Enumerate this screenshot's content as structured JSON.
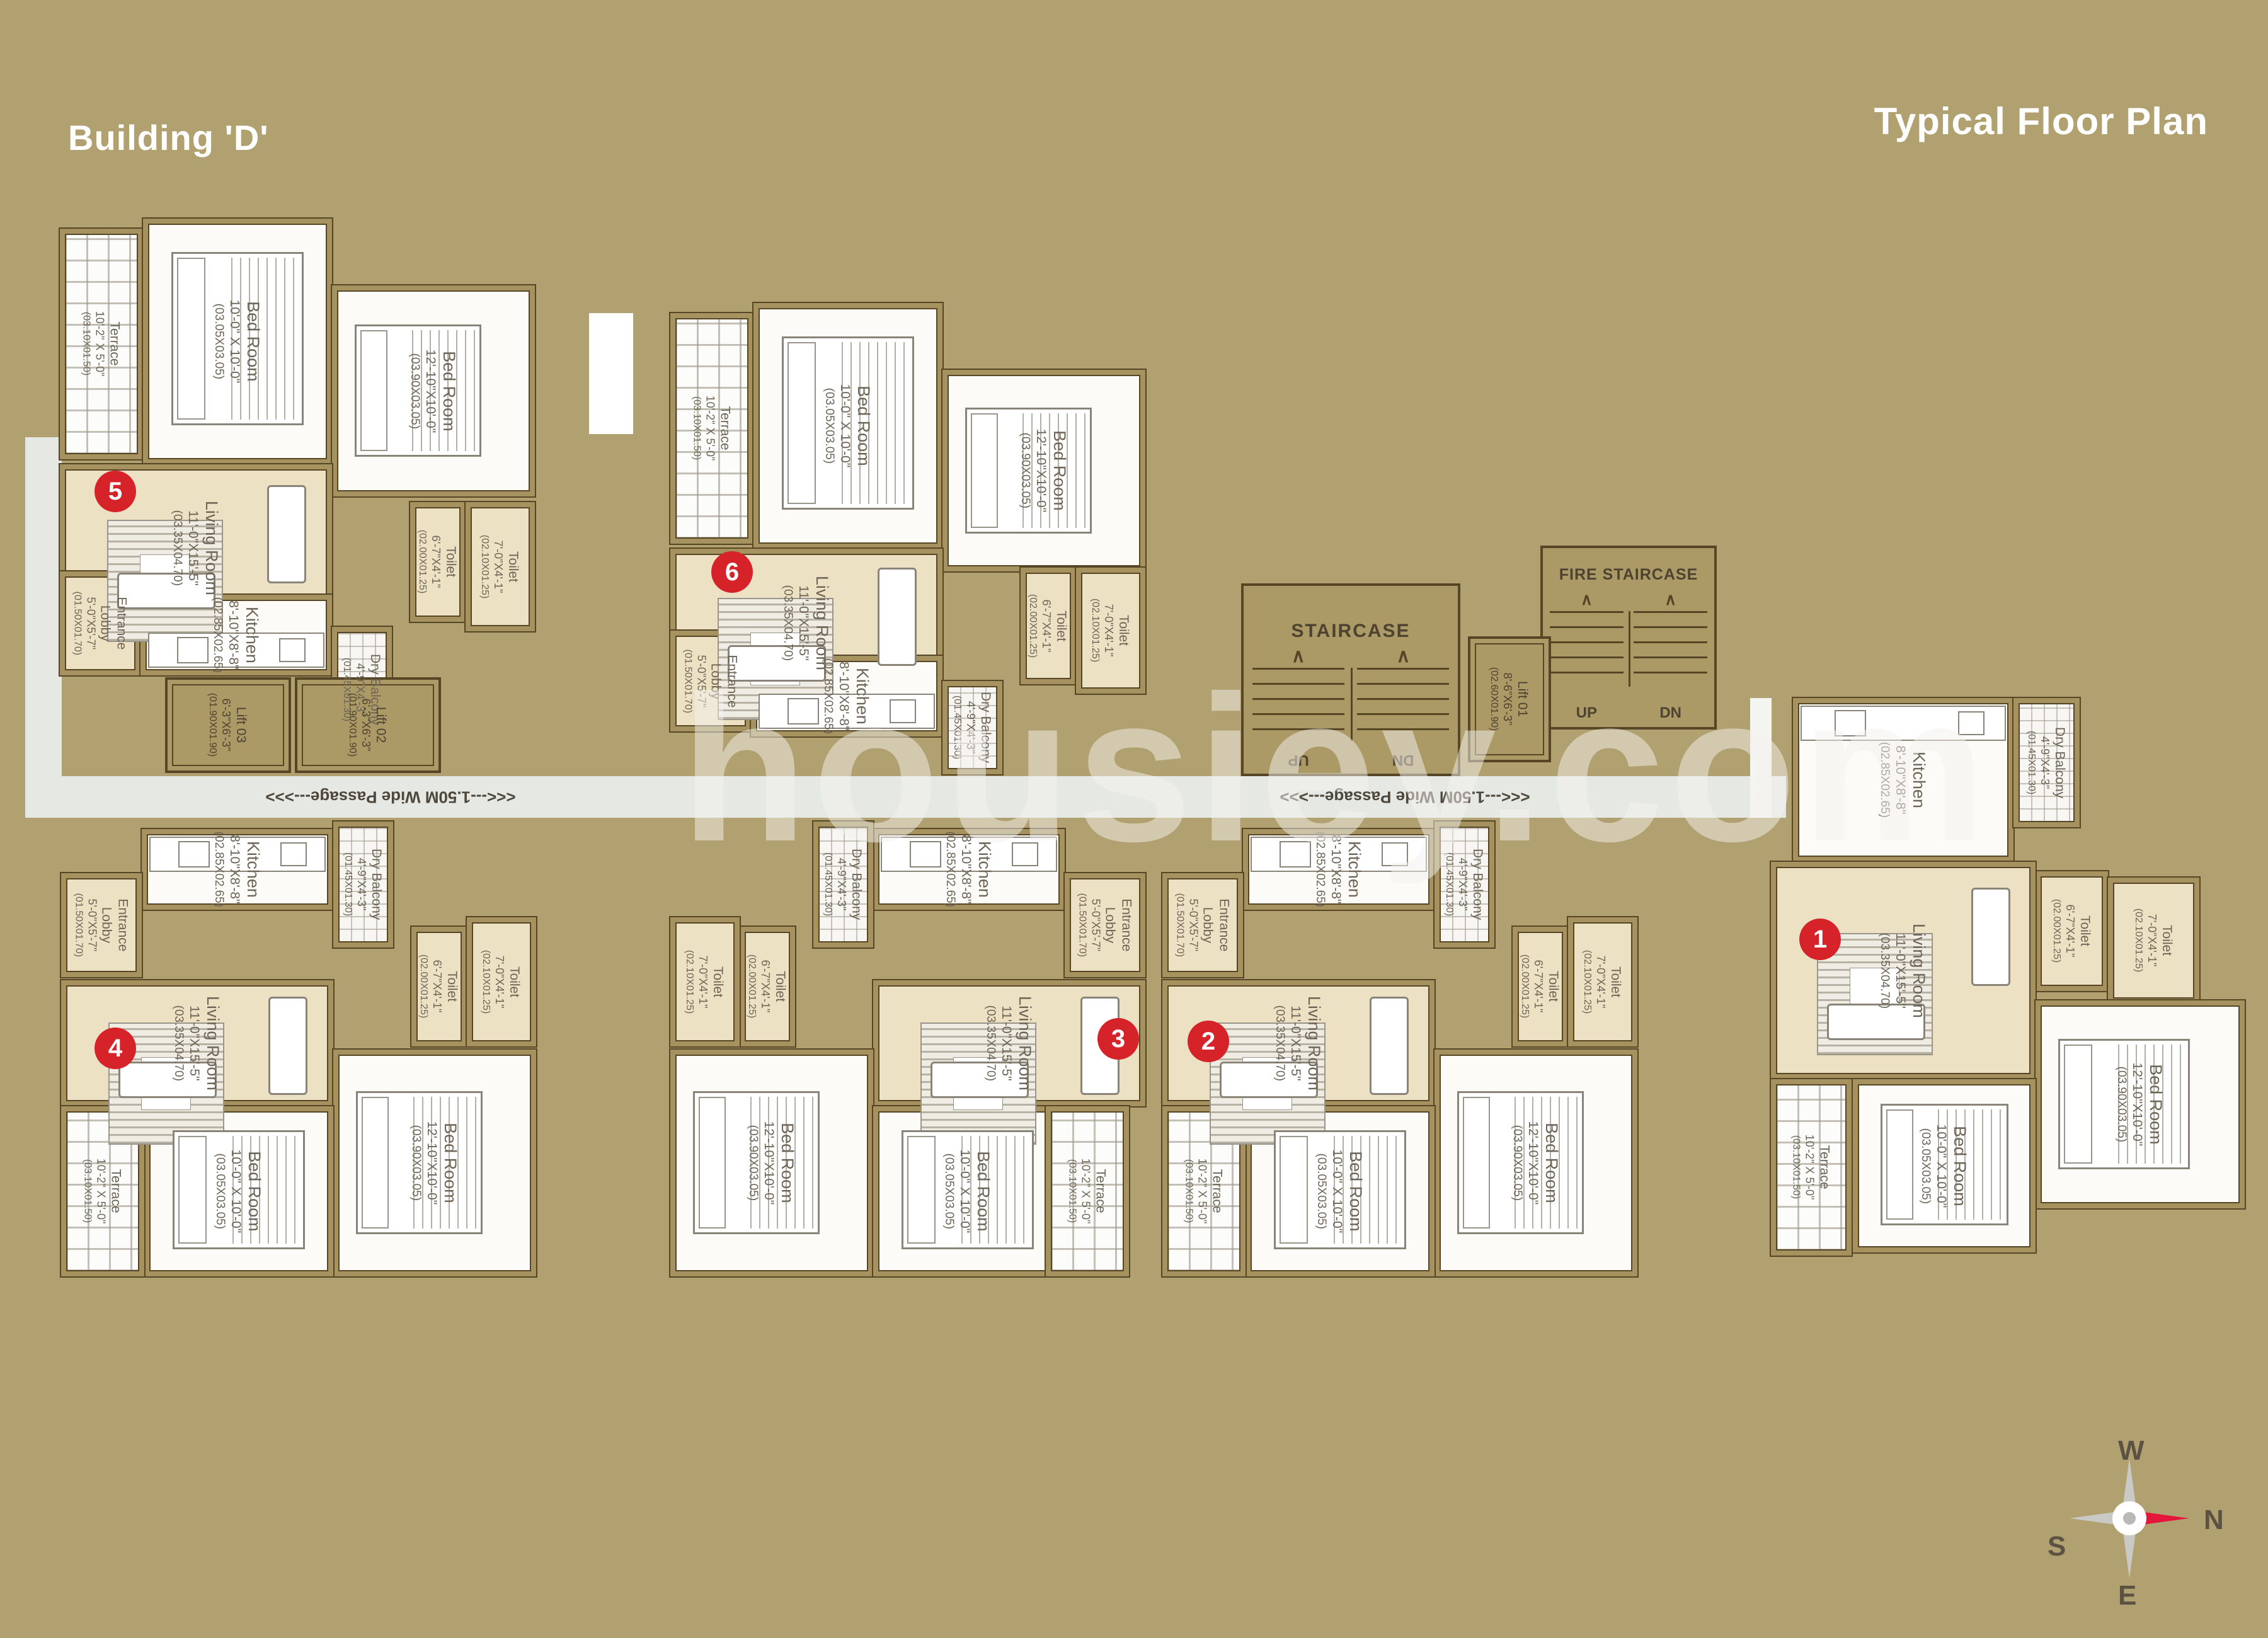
{
  "page": {
    "title_left": "Building 'D'",
    "title_right": "Typical Floor Plan",
    "watermark": "housiey.com",
    "background_color": "#b2a170",
    "accent_red": "#d6232a"
  },
  "room_types": {
    "bed10": {
      "name": "Bed Room",
      "dims": "10'-0\" X 10'-0\"",
      "metric": "(03.05X03.05)"
    },
    "bed12": {
      "name": "Bed Room",
      "dims": "12'-10\"X10'-0\"",
      "metric": "(03.90X03.05)"
    },
    "living": {
      "name": "Living Room",
      "dims": "11'-0\"X15'-5\"",
      "metric": "(03.35X04.70)"
    },
    "kitchen": {
      "name": "Kitchen",
      "dims": "8'-10\"X8'-8\"",
      "metric": "(02.85X02.65)"
    },
    "lobby": {
      "name": "Entrance Lobby",
      "dims": "5'-0\"X5'-7\"",
      "metric": "(01.50X01.70)"
    },
    "dry": {
      "name": "Dry Balcony",
      "dims": "4'-9\"X4'-3\"",
      "metric": "(01.45X01.30)"
    },
    "toilet67": {
      "name": "Toilet",
      "dims": "6'-7\"X4'-1\"",
      "metric": "(02.00X01.25)"
    },
    "toilet70": {
      "name": "Toilet",
      "dims": "7'-0\"X4'-1\"",
      "metric": "(02.10X01.25)"
    },
    "terrace": {
      "name": "Terrace",
      "dims": "10'-2\" X 5'-0\"",
      "metric": "(03.10X01.50)"
    }
  },
  "core": {
    "staircase": "STAIRCASE",
    "fire_staircase": "FIRE STAIRCASE",
    "up": "UP",
    "dn": "DN",
    "passage": "<<<---1.50M Wide Passage--->>>",
    "lift01": {
      "name": "Lift 01",
      "dims": "8'-6\"X6'-3\"",
      "metric": "(02.60X01.90)"
    },
    "lift02": {
      "name": "Lift 02",
      "dims": "6'-3\"X6'-3\"",
      "metric": "(01.90X01.90)"
    },
    "lift03": {
      "name": "Lift 03",
      "dims": "6'-3\"X6'-3\"",
      "metric": "(01.90X01.90)"
    }
  },
  "units": [
    {
      "number": "1"
    },
    {
      "number": "2"
    },
    {
      "number": "3"
    },
    {
      "number": "4"
    },
    {
      "number": "5"
    },
    {
      "number": "6"
    }
  ],
  "compass": {
    "n": "N",
    "s": "S",
    "e": "E",
    "w": "W"
  }
}
